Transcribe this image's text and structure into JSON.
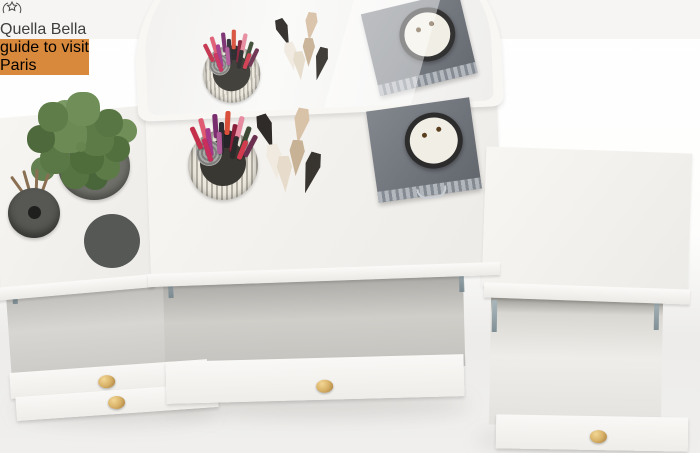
{
  "scene": {
    "label": "White vanity dressing table with mirror, top view, drawers open",
    "background_floor": "#ecebe9",
    "furniture_white": "#f4f2ee",
    "drawer_knob": "#d9b269"
  },
  "mirror": {
    "frame": "#f8f7f4",
    "glass": "#f2f1ef"
  },
  "desk_items": {
    "pencil_colors": [
      "#c4304a",
      "#e05a72",
      "#a43a8a",
      "#7a2d6e",
      "#2e2d33",
      "#d94f3a",
      "#8a1f3a",
      "#e88aa0",
      "#3c4a35",
      "#6b2f4f",
      "#c92f5c",
      "#2b2b2b",
      "#b05a9a",
      "#d23a4e"
    ],
    "tube_colors": [
      "#2e2b28",
      "#d9c3a8",
      "#f0eae0",
      "#c8b296",
      "#38342f",
      "#e7dccb"
    ],
    "cup_metal": "#d8d4c9",
    "felt_roll": "#9a9a98",
    "case_gray": "#6e737b",
    "case_trim": "#a7adb3",
    "candle_face": "#f1eee5",
    "candle_rim": "#2c2c2c"
  },
  "left_table_items": {
    "foliage_green": "#5d7b46",
    "pot_gray": "#70706a",
    "diffuser_gray": "#575753",
    "reed_brown": "#8a6f52",
    "candle_body": "#565856",
    "candle_wax": "#e9e8e1"
  },
  "right_table_items": {
    "flower_cream": "#e8e1cb",
    "flower_pot": "#90908c",
    "clock_metal": "#c3c6ca",
    "clock_face": "#f3f3ef"
  },
  "paris_book": {
    "overline": "guide to visit",
    "title": "Paris",
    "cover": "#d8893c",
    "panel": "#b46a2a",
    "badge": "#e9b93e",
    "tower": "#50270e",
    "globe": "#8a3a12"
  },
  "quella_box": {
    "brand": "Quella Bella",
    "box_color": "#f6f5f3",
    "text_color": "#3f3f3f"
  },
  "left_drawer_palettes": {
    "pink": [
      "#d6b5c2",
      "#bb8fa8",
      "#a06c90",
      "#8a567c",
      "#62435c",
      "#c9a0b4",
      "#b083a0",
      "#96628a",
      "#7c4e70",
      "#523a50"
    ],
    "nude": [
      "#f0e1ca",
      "#e7d2b2",
      "#dabd97",
      "#c7a276",
      "#b08756",
      "#96683c",
      "#e3cba8",
      "#d2b184",
      "#bb9261",
      "#a3763f",
      "#7e5528",
      "#5e3d1e",
      "#4c3018",
      "#3a2513",
      "#6e4a2a",
      "#8a5f35",
      "#2c1e10",
      "#55381f"
    ]
  },
  "makeup_kit": {
    "frame": "#2e2e30",
    "lid_gray": "#6a6c70",
    "wing_left": [
      "#4a4550",
      "#443f4a",
      "#7c3f31",
      "#8a4936",
      "#9c5434",
      "#a85d39",
      "#c1794a",
      "#c98350",
      "#e0a878",
      "#e3ae80",
      "#eccfae",
      "#eed3b5",
      "#f2dfc3",
      "#f4e3c9"
    ],
    "wing_right": [
      "#443f4a",
      "#4a4550",
      "#8a4936",
      "#7c3f31",
      "#a85d39",
      "#9c5434",
      "#c98350",
      "#c1794a",
      "#e3ae80",
      "#e0a878",
      "#eed3b5",
      "#eccfae",
      "#f4e3c9",
      "#f2dfc3"
    ],
    "side_left": [
      "#3f3a44",
      "#75392c",
      "#9c5434",
      "#c1794a",
      "#e0a878",
      "#efd6b8"
    ],
    "side_right": [
      "#3f3a44",
      "#75392c",
      "#9c5434",
      "#c1794a",
      "#e0a878",
      "#efd6b8"
    ],
    "bottom_pans": [
      "#3b362c",
      "#908d80",
      "#6f5b40"
    ]
  },
  "right_drawer_books": {
    "top_book_cover": "#b5a987",
    "top_book_spine": "#4c6077",
    "bottom_book_cover": "#d9a45f",
    "pages_edge": "#efe8d8"
  }
}
